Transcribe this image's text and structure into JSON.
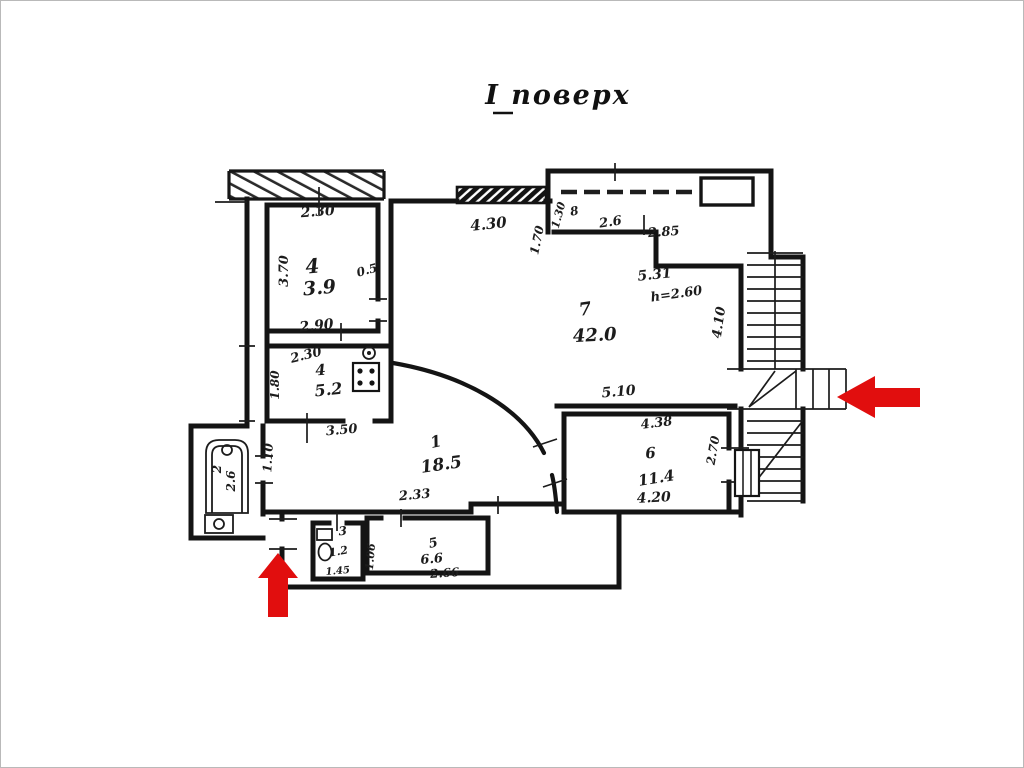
{
  "title": "І поверх",
  "colors": {
    "ink": "#1c1c1c",
    "background": "#ffffff",
    "arrow_red": "#e10e0e",
    "arrow_outline": "#8b0000"
  },
  "rooms": {
    "r1": {
      "num": "1",
      "area": "18.5"
    },
    "r2": {
      "num": "2",
      "area": "2.6"
    },
    "r3": {
      "num": "3",
      "area": "1.2"
    },
    "r4": {
      "num": "4",
      "area": "3.9"
    },
    "r5": {
      "num": "5",
      "area": "6.6"
    },
    "r6": {
      "num": "6",
      "area": "11.4"
    },
    "r7": {
      "num": "7",
      "area": "42.0"
    },
    "kitchen": {
      "num": "4",
      "area": "5.2"
    },
    "balcony": {
      "num": "8",
      "area": "2.6"
    }
  },
  "dims": {
    "r4_top": "2.30",
    "r4_left": "3.70",
    "r4_bottom": "2.90",
    "r4_door": "0.5",
    "kitchen_top": "2.30",
    "kitchen_left": "1.80",
    "hall_width": "3.50",
    "r1_left": "1.10",
    "r1_bottom": "2.33",
    "r7_top": "4.30",
    "r7_bottom": "5.10",
    "r7_right": "4.10",
    "r7_diag": "5.31",
    "r7_height": "h=2.60",
    "balc_left": "1.30",
    "balc_jog": "1.70",
    "balc_top": "2.85",
    "r6_top": "4.38",
    "r6_bottom": "4.20",
    "r6_right": "2.70",
    "r5_left": "1.06",
    "r5_bottom": "2.66",
    "r3_bottom": "1.45"
  }
}
